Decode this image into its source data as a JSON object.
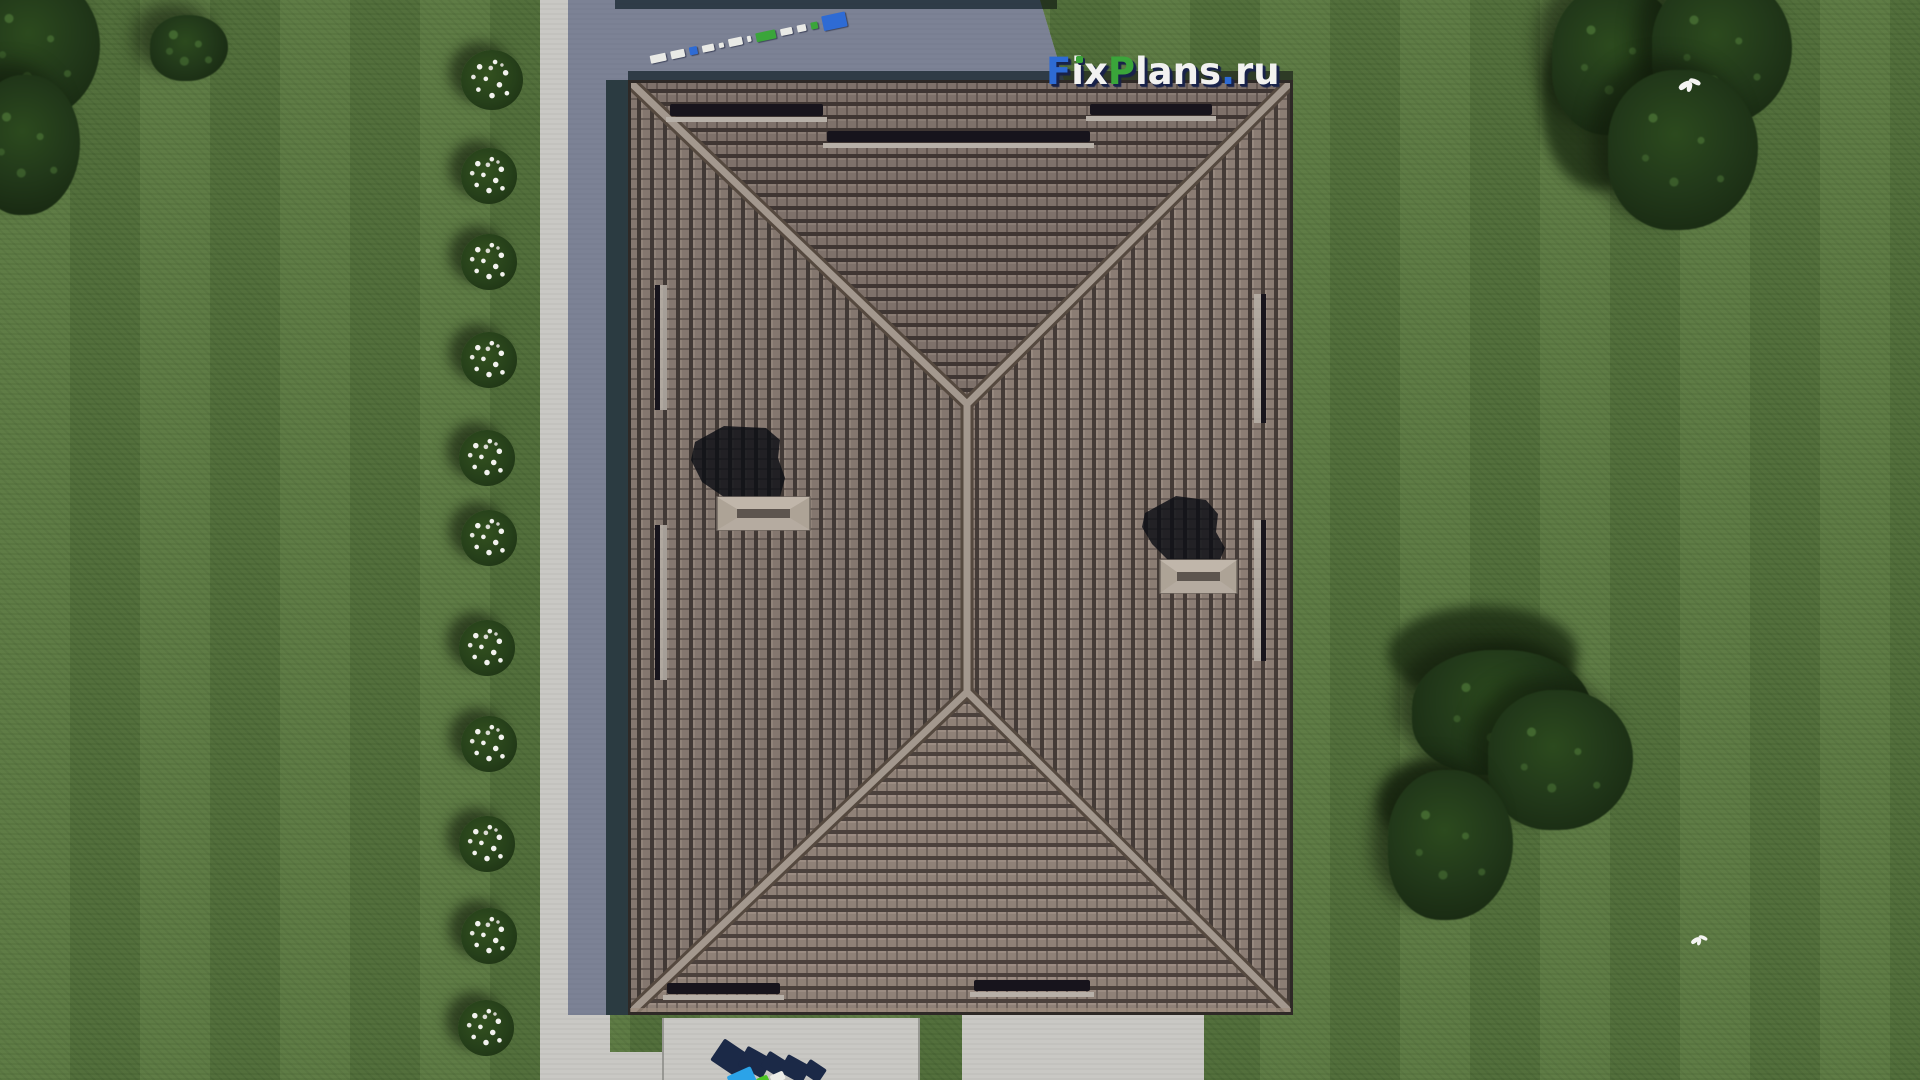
{
  "watermark": {
    "f": "F",
    "i": "i",
    "x": "x",
    "p": "P",
    "lans": "lans",
    "dot": ".",
    "ru": "ru"
  },
  "theme": {
    "grass": "#53713a",
    "grass_dark": "#4c6533",
    "tree": "#2c4a1e",
    "tree_dark": "#15240f",
    "concrete": "#c7c6c2",
    "concrete_shadow": "#2f3b66",
    "roof_tile": "#8b7d74",
    "roof_gap": "#443b37",
    "ridge": "#a3988e",
    "ridge_edge": "#55493f",
    "snow_guard": "#17141c",
    "snow_rail": "#b7b0a8",
    "chimney_cap": "#ada396",
    "logo_blue": "#2e6bd4",
    "logo_green": "#3aa53a",
    "logo_white": "#f2f2f0",
    "logo_shadow": "#18224a"
  }
}
